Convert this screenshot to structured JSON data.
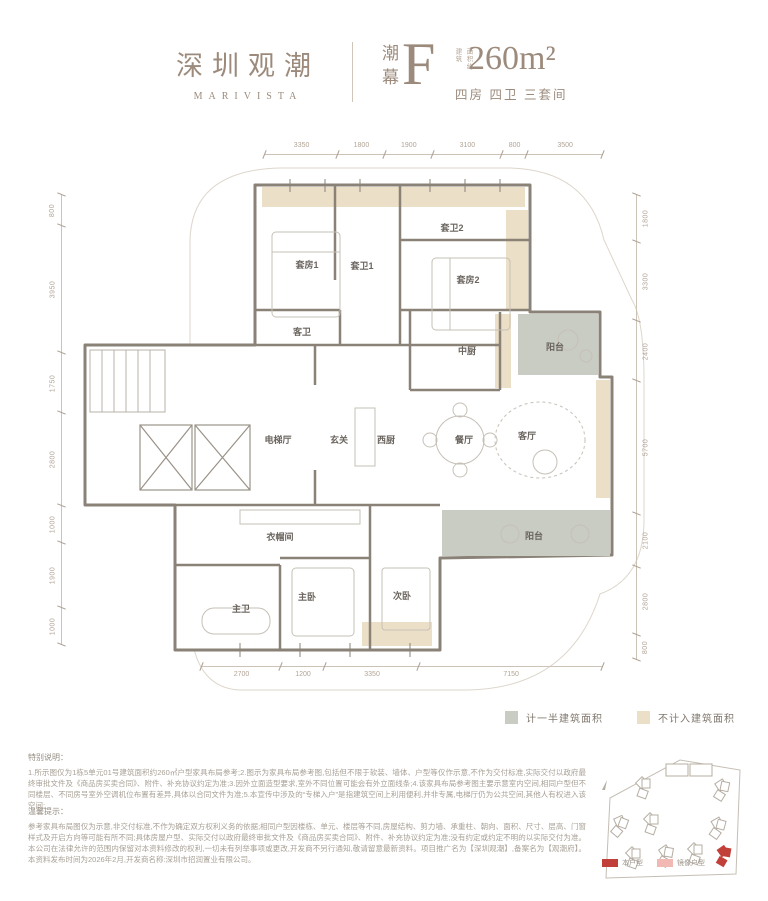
{
  "header": {
    "brand_cn": "深圳观潮",
    "brand_en": "MARIVISTA",
    "series": "潮幕",
    "unit": "F",
    "area_label_col1": "建筑",
    "area_label_col2": "面积约",
    "area": "260m²",
    "layout": "四房 四卫 三套间"
  },
  "plan": {
    "dims_top": [
      3350,
      1800,
      1900,
      3100,
      800,
      3500
    ],
    "dims_bottom": [
      2700,
      1200,
      3350,
      7150
    ],
    "dims_left": [
      800,
      3950,
      1750,
      2800,
      1000,
      1900,
      1000
    ],
    "dims_right": [
      1800,
      3300,
      2400,
      5700,
      2100,
      2800,
      800
    ],
    "rooms": {
      "suite1": "套房1",
      "suite_bath1": "套卫1",
      "suite_bath2": "套卫2",
      "suite2": "套房2",
      "guest_bath": "客卫",
      "chinese_kitchen": "中厨",
      "balcony_top": "阳台",
      "elevator_hall": "电梯厅",
      "foyer": "玄关",
      "west_kitchen": "西厨",
      "dining": "餐厅",
      "living": "客厅",
      "balcony_bottom": "阳台",
      "cloakroom": "衣帽间",
      "master_bath": "主卫",
      "master_bedroom": "主卧",
      "second_bedroom": "次卧"
    }
  },
  "legend": {
    "half": {
      "label": "计一半建筑面积",
      "color": "#c9ccc3"
    },
    "excluded": {
      "label": "不计入建筑面积",
      "color": "#ecdfc7"
    }
  },
  "notes": {
    "special_title": "特别说明：",
    "special_body": "1.所示图仅为1栋5单元01号建筑面积约260㎡户型家具布局参考;2.图示为家具布局参考图,包括但不限于软装、墙体、户型等仅作示意,不作为交付标准,实际交付以政府最终审批文件及《商品房买卖合同》、附件、补充协议约定为准;3.因外立面造型要求,室外不同位置可能会有外立面线条;4.该家具布局参考图主要示意室内空间,相同户型但不同楼层、不同房号室外空调机位布置有差异,具体以合同文件为准;5.本宣传中涉及的“专梯入户”是指建筑空间上利用便利,并非专属,电梯厅仍为公共空间,其他人有权进入该空间;",
    "tips_title": "温馨提示：",
    "tips_body": "参考家具布局图仅为示意,非交付标准,不作为确定双方权利义务的依据;相同户型因楼栋、单元、楼层等不同,房屋结构、剪力墙、承重柱、朝向、面积、尺寸、层高、门窗样式及开启方向等可能有所不同;具体房屋户型、实际交付以政府最终审批文件及《商品房买卖合同》、附件、补充协议约定为准;没有约定或约定不明的以实际交付为准。本公司在法律允许的范围内保留对本资料修改的权利,一切未有列举事项或更改,开发商不另行通知,敬请留意最新资料。项目推广名为【深圳观潮】,备案名为【观潮府】。本资料发布时间为2026年2月,开发商名称:深圳市招润置业有限公司。"
  },
  "siteplan": {
    "legend_this": "本户型",
    "legend_mirror": "镜像户型",
    "color_this": "#c2403a",
    "color_mirror": "#f2b9b4"
  }
}
